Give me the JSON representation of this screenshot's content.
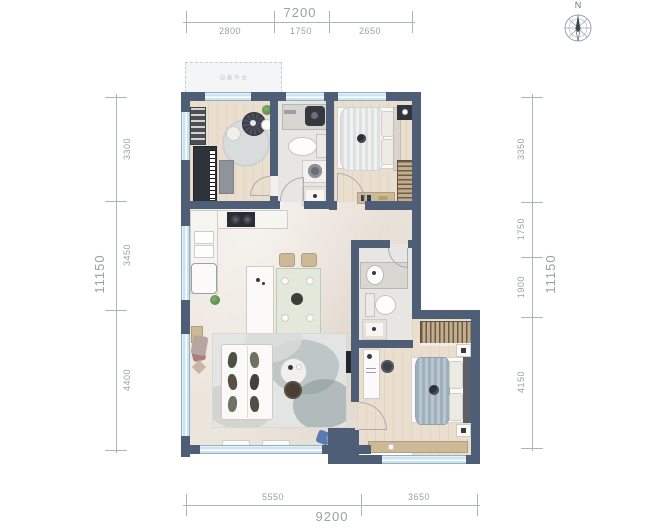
{
  "title": "apartment-floor-plan",
  "compass": {
    "label": "N"
  },
  "balcony": {
    "label": "设备平台"
  },
  "dimensions": {
    "top": {
      "total": "7200",
      "segments": [
        "2800",
        "1750",
        "2650"
      ]
    },
    "bottom": {
      "total": "9200",
      "segments": [
        "5550",
        "3650"
      ]
    },
    "left": {
      "total": "11150",
      "segments": [
        "3300",
        "3450",
        "4400"
      ]
    },
    "right": {
      "total": "11150",
      "segments": [
        "3350",
        "1750",
        "1900",
        "4150"
      ]
    }
  },
  "colors": {
    "wall": "#4e5e77",
    "window": "#cde4f0",
    "floor_marble": "#ece5dc",
    "floor_wood": "#eadfce",
    "floor_tile": "#e8e6e3",
    "dimension_text": "#9aa1a9",
    "plant_green": "#5e8c4d",
    "accent_blue_pillow": "#5b7ab0",
    "wardrobe_tan": "#c3ad8a"
  },
  "icons": {
    "compass": "compass-rose-with-needle",
    "rooms_depicted": [
      "equipment-platform-balcony",
      "piano-study-room",
      "bathroom",
      "secondary-bedroom",
      "kitchen",
      "dining-area",
      "living-room",
      "hallway",
      "ensuite-bathroom",
      "master-bedroom"
    ]
  }
}
